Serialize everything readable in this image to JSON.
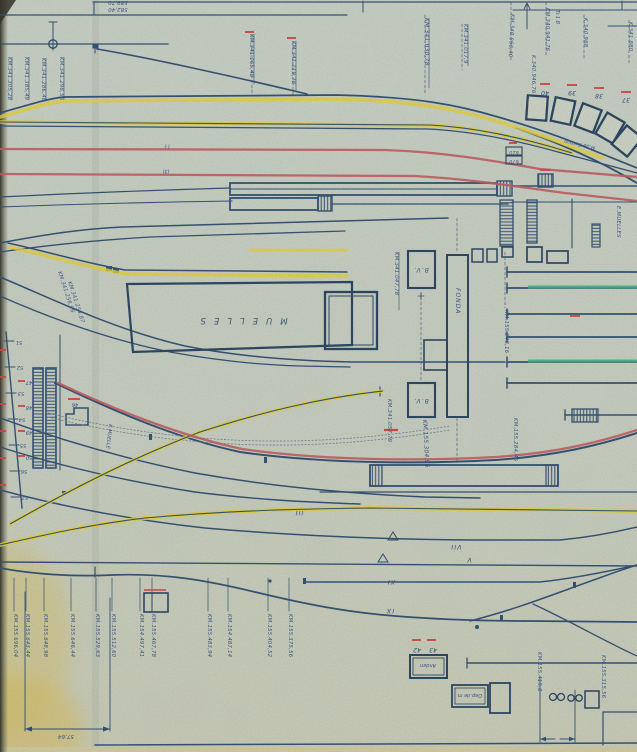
{
  "colors": {
    "paper": "#ccd3c5",
    "ink_navy": "#2e4d72",
    "ink_heavy": "#24415f",
    "label_blue": "#35538b",
    "track_yellow": "#e6d339",
    "track_red": "#c2595e",
    "dash_red": "#d4403f",
    "track_green": "#36b184",
    "stain_yellow": "#d8c26a"
  },
  "labels": {
    "a0": "589,70",
    "a1": "582,40",
    "tl0": "KM.341.305,28",
    "tl1": "KM.341.385,49",
    "tl2": "KM.341.286,46",
    "tl3": "KM.341.298,56",
    "tm0": "KM.341.165,48",
    "tm1": "KM.341.119,78",
    "tm2": "KM.341.030,78",
    "tm3": "KM.341.017,9",
    "tr0": "KM.340.966,40",
    "tr1": "K.340.946,76",
    "tr2": "KM.340.941,76",
    "tr3": "Tr.1 B",
    "tr4": "K.340.968",
    "tr5": "K.341.880",
    "arc0": "40",
    "arc1": "39",
    "arc2": "38",
    "arc3": "37",
    "carbon": "M.de Carbon",
    "p0": "(·)",
    "p1": "(3)",
    "bx0": "610",
    "bx1": "670",
    "muelles": "MUELLES",
    "fonda": "FONDA",
    "bv": "B.V.",
    "emuelles": "E.MUELLES",
    "kmuelle": "K.MUELLE",
    "m0": "KM.341.047,78",
    "m1": "KM.341.256,96",
    "m2": "KM.341.254,87",
    "m3": "KM.341.057,79",
    "m4": "KM.155.304,96",
    "m5": "KM.155.248,16",
    "m6": "KM.155.284,46",
    "lad0": "51",
    "lad1": "52",
    "lad2": "53",
    "lad3": "54",
    "lad4": "55",
    "lad5": "56",
    "lad6": "57",
    "plt0": "47",
    "plt1": "48",
    "plt2": "49",
    "plt3": "50",
    "plt4": "46",
    "rom0": "III",
    "rom1": "VII",
    "rom2": "V",
    "rom3": "XI",
    "rom4": "IX",
    "an0": "42",
    "an1": "43",
    "anden": "Anden",
    "dep": "Dep.de m.",
    "kb0": "KM.155.696,04",
    "kb1": "KM.155.643,44",
    "kb2": "KM.155.648,98",
    "kb3": "KM.155.646,44",
    "kb4": "KM.155.529,63",
    "kb5": "KM.155.512,60",
    "kb6": "KM.154.497,41",
    "kb7": "KM.155.467,78",
    "kb8": "KM.155.483,94",
    "kb9": "KM.154.487,14",
    "kb10": "KM.155.404,52",
    "kb11": "KM.155.375,56",
    "br0": "KM.155.419,8",
    "br1": "KM.155.315,56",
    "d0": "57,64"
  }
}
